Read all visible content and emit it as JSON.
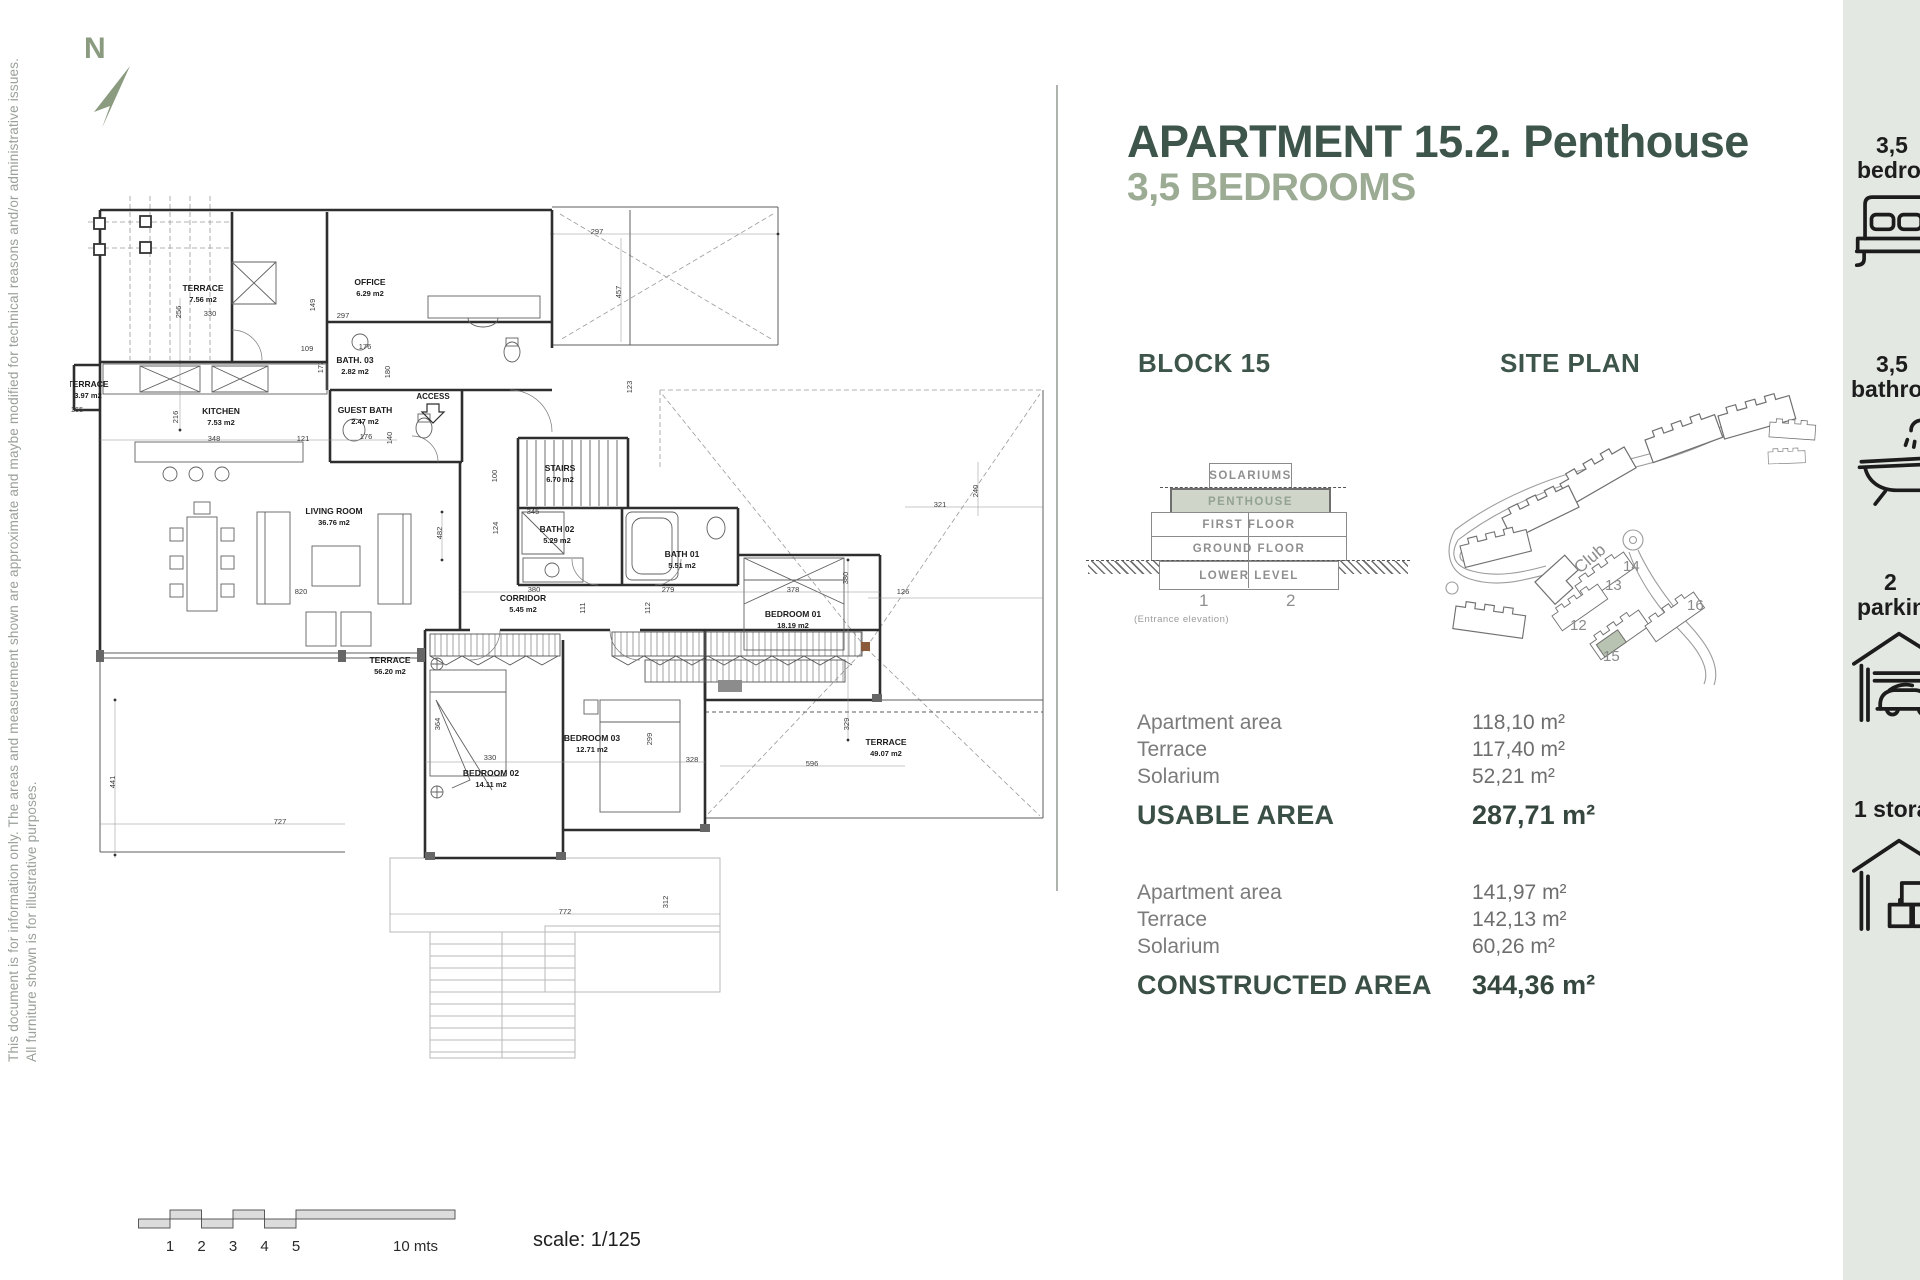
{
  "meta": {
    "north_label": "N"
  },
  "disclaimer": {
    "line1": "This document is for information only. The areas and measurement shown are approximate and maybe modified for technical reasons and/or administrative issues.",
    "line2": "All furniture shown is for illustrative purposes."
  },
  "header": {
    "title": "APARTMENT 15.2. Penthouse",
    "subtitle": "3,5 BEDROOMS"
  },
  "block_section": {
    "heading": "BLOCK 15",
    "elevation": {
      "floors": [
        "SOLARIUMS",
        "PENTHOUSE",
        "FIRST FLOOR",
        "GROUND FLOOR",
        "LOWER LEVEL"
      ],
      "highlighted_floor": "PENTHOUSE",
      "unit_1": "1",
      "unit_2": "2",
      "caption": "(Entrance elevation)"
    }
  },
  "site_plan": {
    "heading": "SITE PLAN",
    "club_label": "Club",
    "block_labels": {
      "b12": "12",
      "b13": "13",
      "b14": "14",
      "b15": "15",
      "b16": "16"
    },
    "highlight_color": "#b9c3b1"
  },
  "usable_area": {
    "rows": [
      {
        "label": "Apartment area",
        "value": "118,10 m²"
      },
      {
        "label": "Terrace",
        "value": "117,40 m²"
      },
      {
        "label": "Solarium",
        "value": "52,21 m²"
      }
    ],
    "total_label": "USABLE AREA",
    "total_value": "287,71 m²"
  },
  "constructed_area": {
    "rows": [
      {
        "label": "Apartment area",
        "value": "141,97 m²"
      },
      {
        "label": "Terrace",
        "value": "142,13 m²"
      },
      {
        "label": "Solarium",
        "value": "60,26 m²"
      }
    ],
    "total_label": "CONSTRUCTED AREA",
    "total_value": "344,36 m²"
  },
  "sidebar": {
    "items": [
      {
        "icon": "bed-icon",
        "line1": "3,5",
        "line2": "bedrooms"
      },
      {
        "icon": "bath-icon",
        "line1": "3,5",
        "line2": "bathrooms"
      },
      {
        "icon": "parking-icon",
        "line1": "2",
        "line2": "parking"
      },
      {
        "icon": "storage-icon",
        "line1": "1 storage",
        "line2": ""
      }
    ]
  },
  "scale": {
    "ticks": [
      "1",
      "2",
      "3",
      "4",
      "5"
    ],
    "end_label": "10 mts",
    "label": "scale: 1/125"
  },
  "colors": {
    "accent_dark": "#3e554b",
    "accent_sage": "#9cab94",
    "penthouse_fill": "#cfd6c9",
    "sidebar_bg": "#e4e8e2"
  },
  "floor_plan": {
    "access_label": "ACCESS",
    "rooms": [
      {
        "name": "TERRACE",
        "area": "7.56 m2"
      },
      {
        "name": "OFFICE",
        "area": "6.29 m2"
      },
      {
        "name": "BATH. 03",
        "area": "2.82 m2"
      },
      {
        "name": "KITCHEN",
        "area": "7.53 m2"
      },
      {
        "name": "GUEST BATH",
        "area": "2.47 m2"
      },
      {
        "name": "TERRACE",
        "area": "3.97 m2"
      },
      {
        "name": "LIVING ROOM",
        "area": "36.76 m2"
      },
      {
        "name": "STAIRS",
        "area": "6.70 m2"
      },
      {
        "name": "BATH 02",
        "area": "5.29 m2"
      },
      {
        "name": "BATH 01",
        "area": "5.51 m2"
      },
      {
        "name": "CORRIDOR",
        "area": "5.45 m2"
      },
      {
        "name": "BEDROOM 01",
        "area": "18.19 m2"
      },
      {
        "name": "TERRACE",
        "area": "56.20 m2"
      },
      {
        "name": "BEDROOM 02",
        "area": "14.11 m2"
      },
      {
        "name": "BEDROOM 03",
        "area": "12.71 m2"
      },
      {
        "name": "TERRACE",
        "area": "49.07 m2"
      }
    ],
    "dims": [
      "256",
      "330",
      "149",
      "297",
      "109",
      "176",
      "172",
      "180",
      "216",
      "348",
      "121",
      "176",
      "140",
      "100",
      "406",
      "482",
      "345",
      "124",
      "820",
      "380",
      "279",
      "378",
      "111",
      "112",
      "126",
      "380",
      "364",
      "330",
      "328",
      "299",
      "329",
      "596",
      "441",
      "727",
      "772",
      "312",
      "297",
      "457",
      "123",
      "240",
      "321",
      "241",
      "165"
    ]
  }
}
